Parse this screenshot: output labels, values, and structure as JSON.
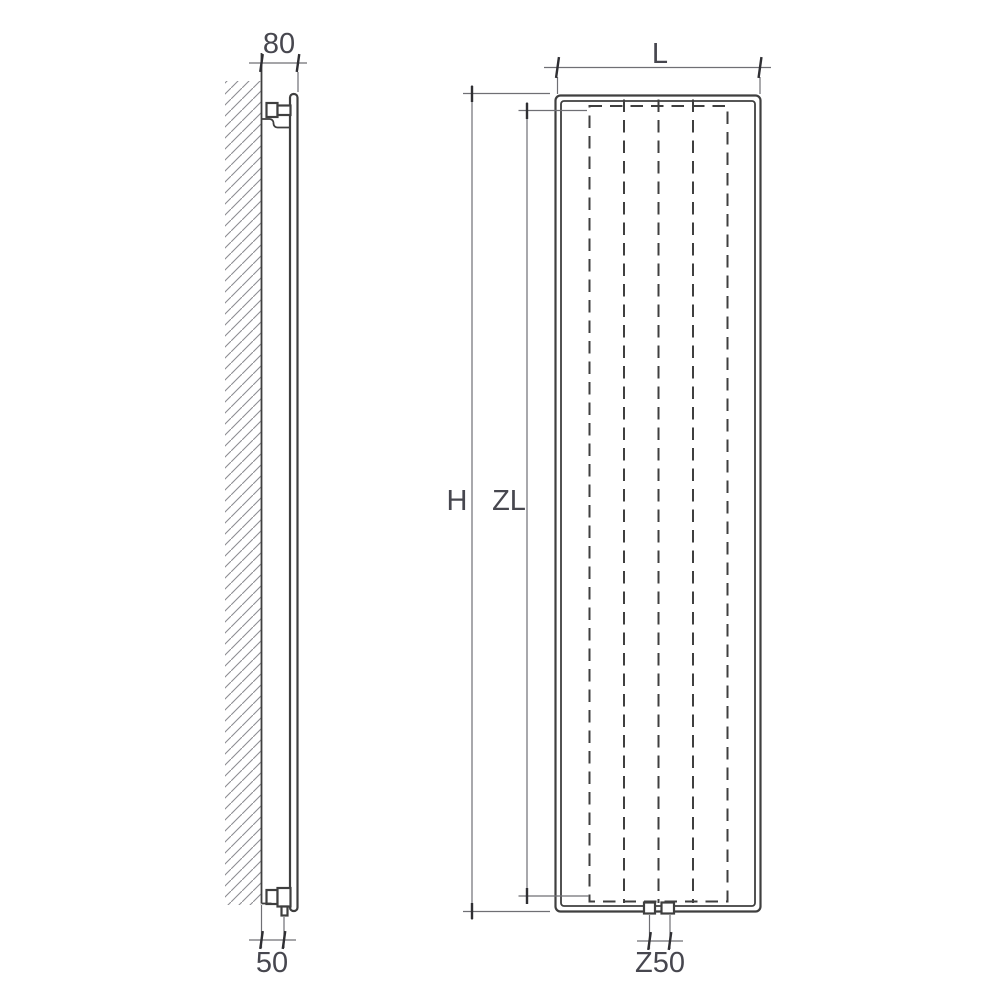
{
  "drawing": {
    "title": "vertical radiator installation drawing, side view and front view",
    "background_color": "#ffffff",
    "line_color": "#3f3f3f",
    "dim_color": "#6f6f74",
    "tick_color": "#2f2f33",
    "hatch_color": "#8d8d92",
    "text_color": "#47474f",
    "labels": {
      "wall_depth": "80",
      "bottom_offset": "50",
      "width": "L",
      "height": "H",
      "element_height": "ZL",
      "connection_spacing": "Z50"
    }
  }
}
